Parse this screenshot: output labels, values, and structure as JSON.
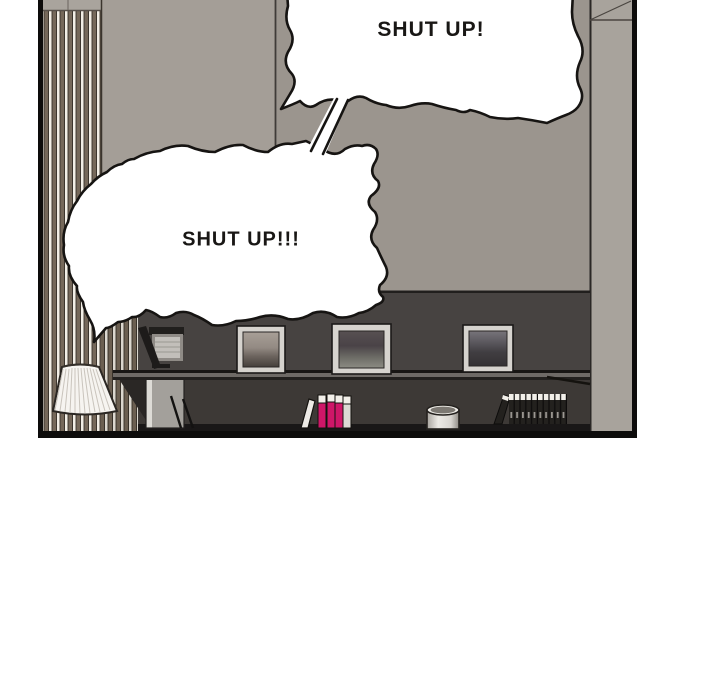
{
  "panel": {
    "type": "comic-panel",
    "bubble_top": {
      "text": "SHUT UP!"
    },
    "bubble_bottom": {
      "text": "SHUT UP!!!"
    },
    "colors": {
      "background": "#ffffff",
      "panel_border": "#0d0c0b",
      "ink_outline": "#161412",
      "wall_left": "#a49e97",
      "wall_right": "#9b958e",
      "wall_column": "#a8a39c",
      "dark_wall": "#474341",
      "stripe_brown": "#75685a",
      "stripe_cream": "#f2eee6",
      "lamp_shade": "#f6f4f0",
      "accent_pink_books": "#cf1668",
      "bubble_fill": "#ffffff"
    },
    "objects": [
      "striped-curtain",
      "left-wall",
      "right-wall",
      "wall-column",
      "dark-wall",
      "picture-frame-1",
      "picture-frame-2",
      "picture-frame-3",
      "shelf",
      "floor-lamp",
      "monitor",
      "desk-wedge",
      "chair",
      "pink-books",
      "dark-books",
      "jar"
    ]
  }
}
